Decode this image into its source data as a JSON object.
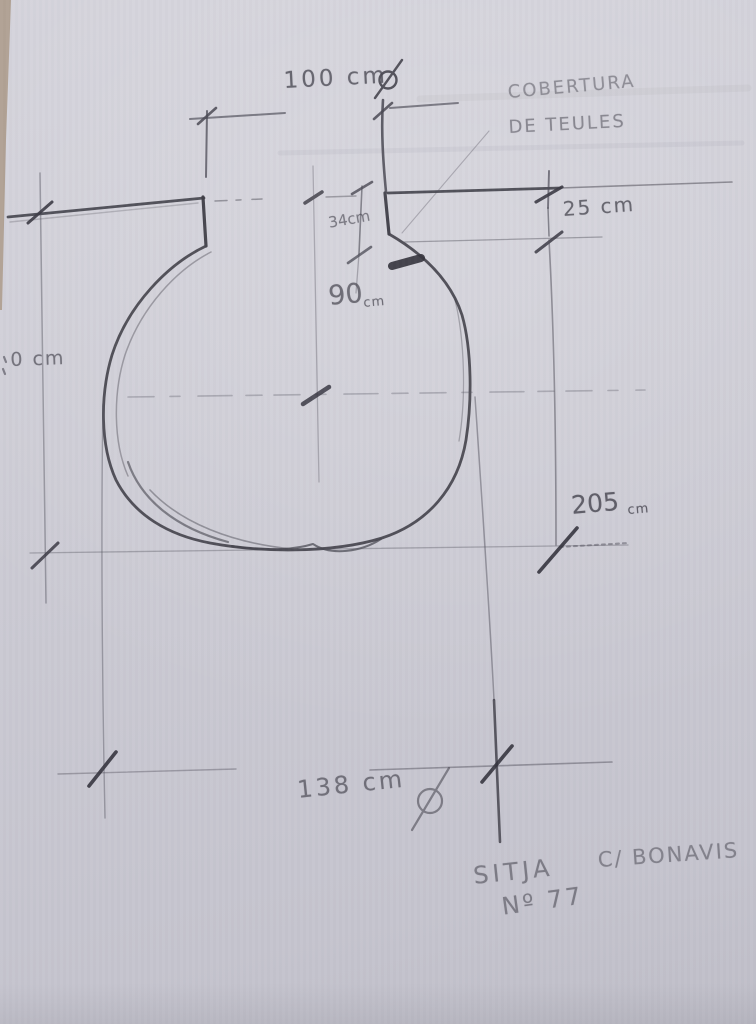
{
  "photo": {
    "description": "pencil sketch of a silo cross-section with dimensions",
    "colors": {
      "paper": "#cdccd5",
      "pencil_dark": "#43424b",
      "pencil_mid": "#67666f",
      "pencil_light": "#8f8e96",
      "table_edge": "#b2a493"
    },
    "annotations": {
      "top_diameter": "100 cm",
      "cover_note_line1": "COBERTURA",
      "cover_note_line2": "DE TEULES",
      "neck_depth": "34cm",
      "neck_width_value": "90",
      "neck_width_unit": "cm",
      "right_depth": "25 cm",
      "left_depth_partial": "0 cm",
      "chamber_depth_value": "205",
      "chamber_depth_unit": "cm",
      "bottom_diameter": "138 cm",
      "site_name": "SITJA",
      "site_street": "C/ BONAVIS",
      "site_number": "Nº 77"
    }
  }
}
